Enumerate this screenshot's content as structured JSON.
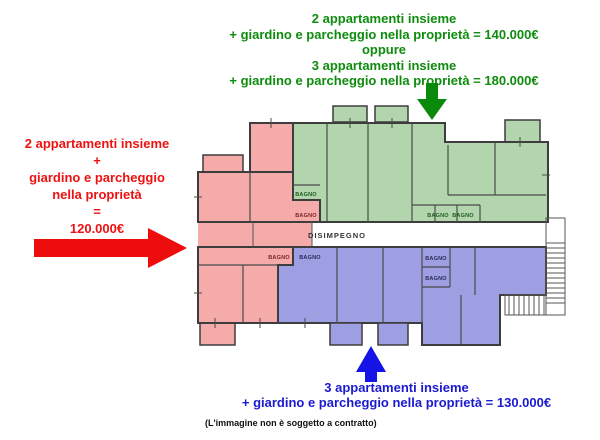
{
  "top_annotation": {
    "color": "#0d8c0d",
    "lines": [
      "2 appartamenti insieme",
      "+ giardino e parcheggio nella proprietà = 140.000€",
      "oppure",
      "3 appartamenti insieme",
      "+ giardino e parcheggio nella proprietà = 180.000€"
    ]
  },
  "left_annotation": {
    "color": "#ee1111",
    "lines": [
      "2 appartamenti insieme",
      "+",
      "giardino e parcheggio",
      "nella proprietà",
      "=",
      "120.000€"
    ]
  },
  "bottom_annotation": {
    "color": "#1a1ad0",
    "lines": [
      "3 appartamenti insieme",
      "+ giardino e parcheggio nella proprietà = 130.000€"
    ]
  },
  "disclaimer": "(L'immagine non è soggetto a contratto)",
  "arrows": {
    "green": "#0a8a0a",
    "red": "#ee0d0d",
    "blue": "#1414e6"
  },
  "plan": {
    "labels": {
      "bagno": "BAGNO",
      "disimpegno": "DISIMPEGNO"
    },
    "colors": {
      "pink": "#f6abab",
      "green": "#b2d5ae",
      "blue": "#9e9fe2",
      "bagno_on_pink": "#7a2222",
      "bagno_on_green": "#1d5c1d",
      "bagno_on_blue": "#2a2a55"
    }
  }
}
